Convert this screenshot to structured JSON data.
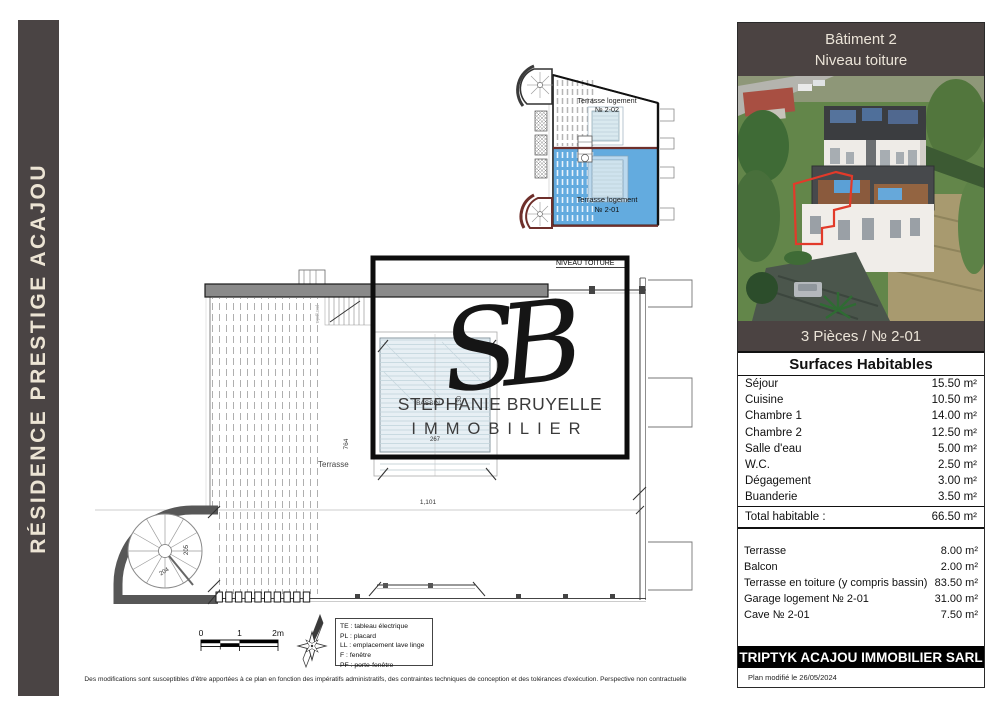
{
  "sidebar": {
    "title": "RÉSIDENCE PRESTIGE ACAJOU"
  },
  "mini_plan": {
    "top_line1": "Terrasse logement",
    "top_line2": "№ 2-02",
    "bottom_line1": "Terrasse logement",
    "bottom_line2": "№ 2-01"
  },
  "plan": {
    "level_label": "NIVEAU TOITURE",
    "terrasse_label": "Terrasse",
    "pergola_label": "pergola",
    "bassin_label": "BASSIN",
    "dim_width": "1,101",
    "dim_height": "764",
    "dim_stair_a": "204",
    "dim_stair_b": "205",
    "dim_bassin_w": "267",
    "dim_bassin_h": "130"
  },
  "watermark": {
    "monogram": "SB",
    "name": "STEPHANIE BRUYELLE",
    "field": "IMMOBILIER"
  },
  "panel": {
    "header_line1": "Bâtiment 2",
    "header_line2": "Niveau toiture",
    "unit_label": "3 Pièces / № 2-01",
    "table_title": "Surfaces Habitables",
    "rooms": [
      {
        "label": "Séjour",
        "value": "15.50 m²"
      },
      {
        "label": "Cuisine",
        "value": "10.50 m²"
      },
      {
        "label": "Chambre 1",
        "value": "14.00 m²"
      },
      {
        "label": "Chambre 2",
        "value": "12.50 m²"
      },
      {
        "label": "Salle d'eau",
        "value": "5.00 m²"
      },
      {
        "label": "W.C.",
        "value": "2.50 m²"
      },
      {
        "label": "Dégagement",
        "value": "3.00 m²"
      },
      {
        "label": "Buanderie",
        "value": "3.50 m²"
      }
    ],
    "total": {
      "label": "Total habitable :",
      "value": "66.50 m²"
    },
    "annexes": [
      {
        "label": "Terrasse",
        "value": "8.00 m²"
      },
      {
        "label": "Balcon",
        "value": "2.00 m²"
      },
      {
        "label": "Terrasse en toiture (y compris bassin)",
        "value": "83.50 m²"
      },
      {
        "label": "Garage logement № 2-01",
        "value": "31.00 m²"
      },
      {
        "label": "Cave № 2-01",
        "value": "7.50 m²"
      }
    ],
    "company": "TRIPTYK ACAJOU IMMOBILIER SARL",
    "modified": "Plan modifié  le 26/05/2024"
  },
  "scale_bar": {
    "t0": "0",
    "t1": "1",
    "t2": "2m"
  },
  "legend": {
    "items": [
      {
        "text": "TE : tableau électrique"
      },
      {
        "text": "PL : placard"
      },
      {
        "text": "LL : emplacement lave linge"
      },
      {
        "text": "F : fenêtre"
      },
      {
        "text": "PF : porte-fenêtre"
      }
    ]
  },
  "disclaimer": "Des modifications sont susceptibles d'être apportées à ce plan en fonction des impératifs administratifs, des contraintes techniques de conception et des tolérances d'exécution. Perspective non contractuelle",
  "colors": {
    "panel_header_bg": "#4b4342",
    "sidebar_bg": "#4a4444",
    "highlight_blue": "#63abdf",
    "outline_red": "#e23a2a",
    "footer_bg": "#000000"
  }
}
